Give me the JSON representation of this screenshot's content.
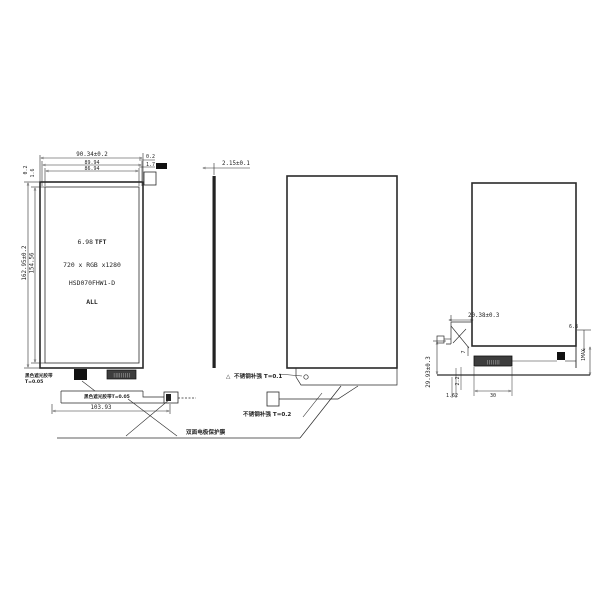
{
  "front_view": {
    "dim_width_outer": "90.34±0.2",
    "dim_width_mid": "89.94",
    "dim_width_aa": "86.94",
    "dim_offset_right_1": "0.2",
    "dim_offset_right_2": "1.7",
    "dim_offset_left_1": "0.2",
    "dim_offset_left_2": "1.6",
    "dim_height_outer": "162.95±0.2",
    "dim_height_aa": "154.56",
    "size_label": "6.98",
    "tft_label": "TFT",
    "resolution_label": "720 x RGB x1280",
    "model_label": "HSD070FHW1-D",
    "all_label": "ALL",
    "dim_fpc_width": "103.93",
    "tape_note": "黑色遮光胶带T=0.05",
    "left_note_line1": "黑色遮光胶带",
    "left_note_line2": "T=0.05",
    "connector_pins": "|||||||||"
  },
  "side_view": {
    "dim_thickness": "2.15±0.1"
  },
  "back_view": {
    "flag_symbol": "△",
    "stiffener_note_1": "不锈钢补强 T=0.1",
    "stiffener_note_2": "不锈钢补强 T=0.2"
  },
  "shared": {
    "bottom_note": "双面电极保护膜"
  },
  "right_view": {
    "dim_fpc": "20.38±0.3",
    "dim_edge": "6.8",
    "dim_max": "1MAX",
    "dim_step": "7",
    "dim_gap": "2.2",
    "dim_offset": "1.62",
    "dim_connector": "30",
    "dim_height": "29.93±0.3",
    "connector_pins": "|||||||"
  }
}
